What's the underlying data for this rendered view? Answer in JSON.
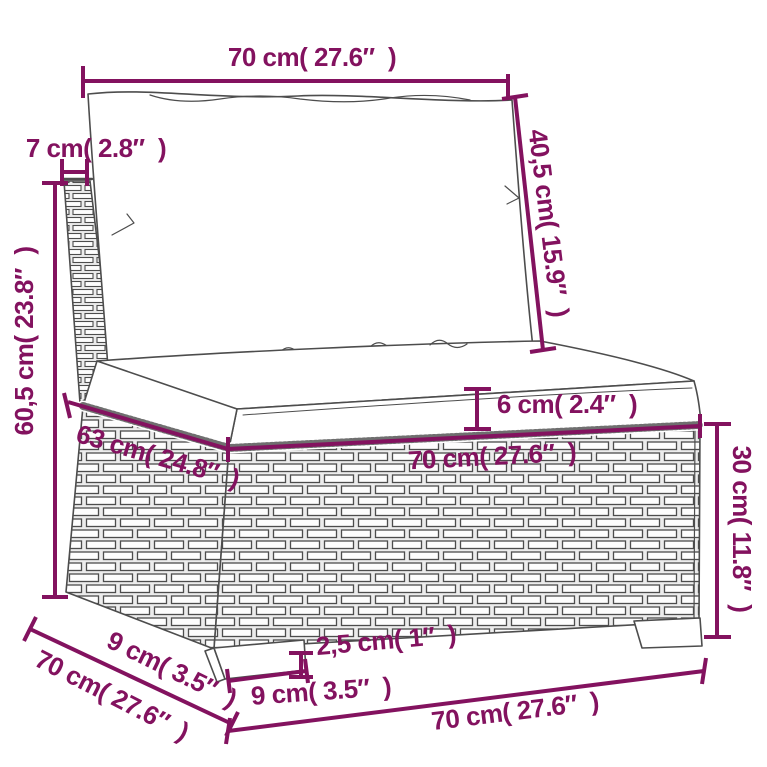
{
  "diagram": {
    "subject": "rattan-sofa-middle-section-dimension-drawing",
    "accent_color": "#83125f",
    "drawing_line_color": "#4d4d4d",
    "background": "#ffffff"
  },
  "dimensions": {
    "back_width": {
      "cm": "70",
      "inches": "27.6",
      "text": "70 cm( 27.6″  )"
    },
    "back_thickness": {
      "cm": "7",
      "inches": "2.8",
      "text": "7 cm( 2.8″  )"
    },
    "back_cushion_height": {
      "cm": "40,5",
      "inches": "15.9",
      "text": "40,5 cm( 15.9″  )"
    },
    "total_height": {
      "cm": "60,5",
      "inches": "23.8",
      "text": "60,5 cm( 23.8″  )"
    },
    "seat_cushion_thickness": {
      "cm": "6",
      "inches": "2.4",
      "text": "6 cm( 2.4″  )"
    },
    "seat_depth": {
      "cm": "63",
      "inches": "24.8",
      "text": "63 cm( 24.8″  )"
    },
    "seat_width": {
      "cm": "70",
      "inches": "27.6",
      "text": "70 cm( 27.6″  )"
    },
    "base_height": {
      "cm": "30",
      "inches": "11.8",
      "text": "30 cm( 11.8″  )"
    },
    "leg_inset_depth": {
      "cm": "9",
      "inches": "3.5",
      "text": "9 cm( 3.5″  )"
    },
    "total_depth": {
      "cm": "70",
      "inches": "27.6",
      "text": "70 cm( 27.6″  )"
    },
    "leg_height": {
      "cm": "2,5",
      "inches": "1",
      "text": "2,5 cm( 1″  )"
    },
    "leg_width": {
      "cm": "9",
      "inches": "3.5",
      "text": "9 cm( 3.5″  )"
    },
    "total_width": {
      "cm": "70",
      "inches": "27.6",
      "text": "70 cm( 27.6″  )"
    }
  }
}
